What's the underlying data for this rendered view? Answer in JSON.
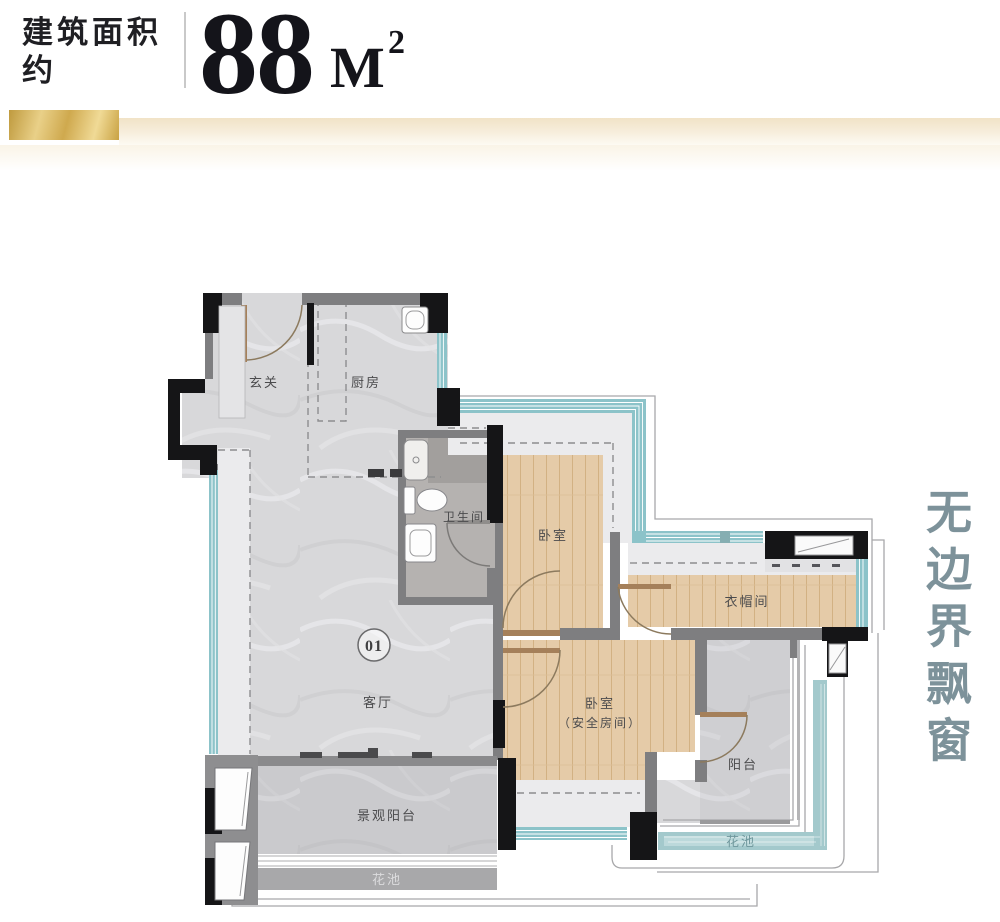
{
  "header": {
    "area_label_line1": "建筑面积",
    "area_label_line2": "约",
    "area_value": "88",
    "area_unit": "M",
    "area_unit_exponent": "2"
  },
  "slogan": {
    "text": "无边界飘窗"
  },
  "floorplan": {
    "unit_badge": "01",
    "rooms": {
      "entry": "玄关",
      "kitchen": "厨房",
      "bathroom": "卫生间",
      "bedroom1": "卧室",
      "cloakroom": "衣帽间",
      "living_room": "客厅",
      "bedroom2": "卧室",
      "bedroom2_note": "（安全房间）",
      "balcony": "阳台",
      "view_balcony": "景观阳台",
      "flower_bed_left": "花池",
      "flower_bed_right": "花池"
    },
    "colors": {
      "wall_black": "#151517",
      "wall_gray": "#7e7e80",
      "window_teal": "#8cc3c9",
      "wood_floor": "#e5cba8",
      "marble_floor": "#d8d8da",
      "flower_bed_teal": "#a3c9cc",
      "accent_gold": "#caa54c",
      "slogan_color": "#7d929a"
    }
  }
}
